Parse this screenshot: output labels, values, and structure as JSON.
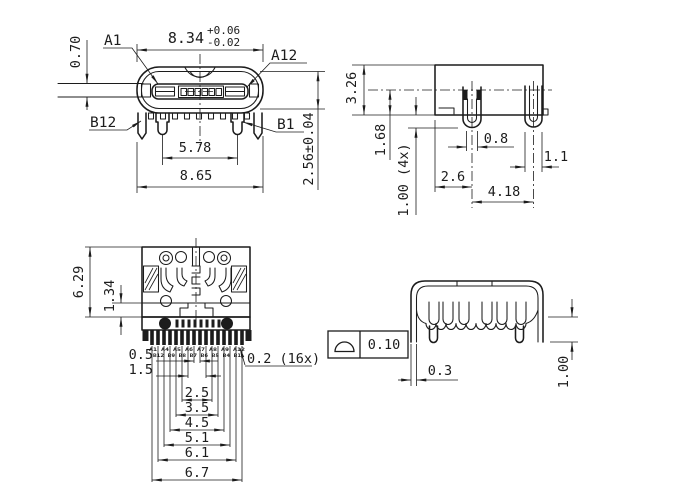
{
  "colors": {
    "line": "#1c1c1c",
    "background": "#ffffff"
  },
  "front_view": {
    "dim_shell_width": "8.34",
    "dim_shell_width_tol_plus": "+0.06",
    "dim_shell_width_tol_minus": "-0.02",
    "pin_a1": "A1",
    "pin_a12": "A12",
    "pin_b12": "B12",
    "pin_b1": "B1",
    "dim_side_plate_height": "0.70",
    "dim_leg_span": "5.78",
    "dim_overall_width": "8.65",
    "dim_shell_height": "2.56±0.04"
  },
  "side_view": {
    "dim_overall_height": "3.26",
    "dim_centerline_to_base": "1.68",
    "dim_leg_length": "1.00 (4x)",
    "dim_front_leg_width": "0.8",
    "dim_rear_leg_width": "1.1",
    "dim_front_leg_offset": "2.6",
    "dim_leg_pitch": "4.18"
  },
  "top_view": {
    "dim_body_depth": "6.29",
    "dim_front_depth": "1.34",
    "pin_row_a": "A1 A4 A5 A6 A7 A8 A9 A12",
    "pin_row_b": "B12 B9 B8 B7 B6 B5 B4 B1",
    "dim_pin_width": "0.2 (16x)",
    "ladder": [
      "0.5",
      "1.5",
      "2.5",
      "3.5",
      "4.5",
      "5.1",
      "6.1",
      "6.7"
    ]
  },
  "rear_view": {
    "gdt_symbol": "profile-of-a-surface",
    "gdt_value": "0.10",
    "dim_shell_thickness": "0.3",
    "dim_leg_length": "1.00"
  }
}
